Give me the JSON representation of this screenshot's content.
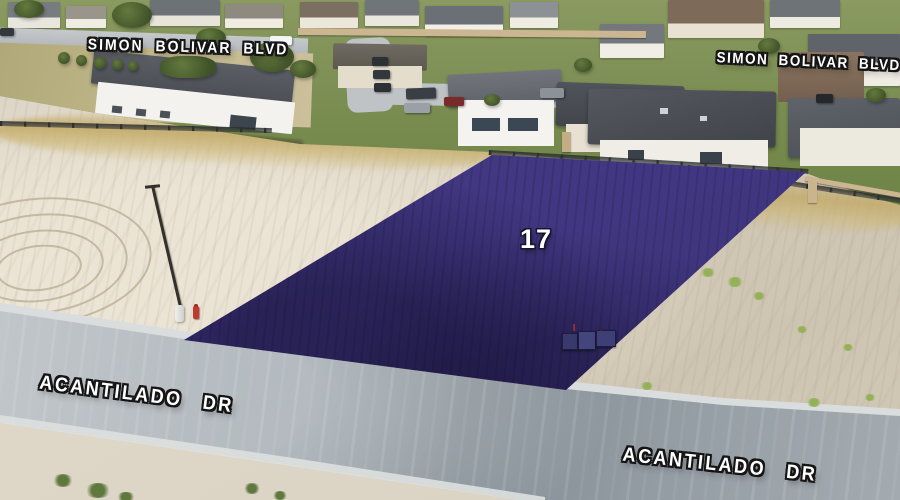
{
  "overlay": {
    "lot_number": "17",
    "lot_fill_color": "#3c3278",
    "labels": {
      "simon_bolivar_left": "SIMON BOLIVAR BLVD",
      "simon_bolivar_right": "SIMON BOLIVAR BLVD",
      "acantilado_left": "ACANTILADO DR",
      "acantilado_right": "ACANTILADO DR"
    }
  }
}
